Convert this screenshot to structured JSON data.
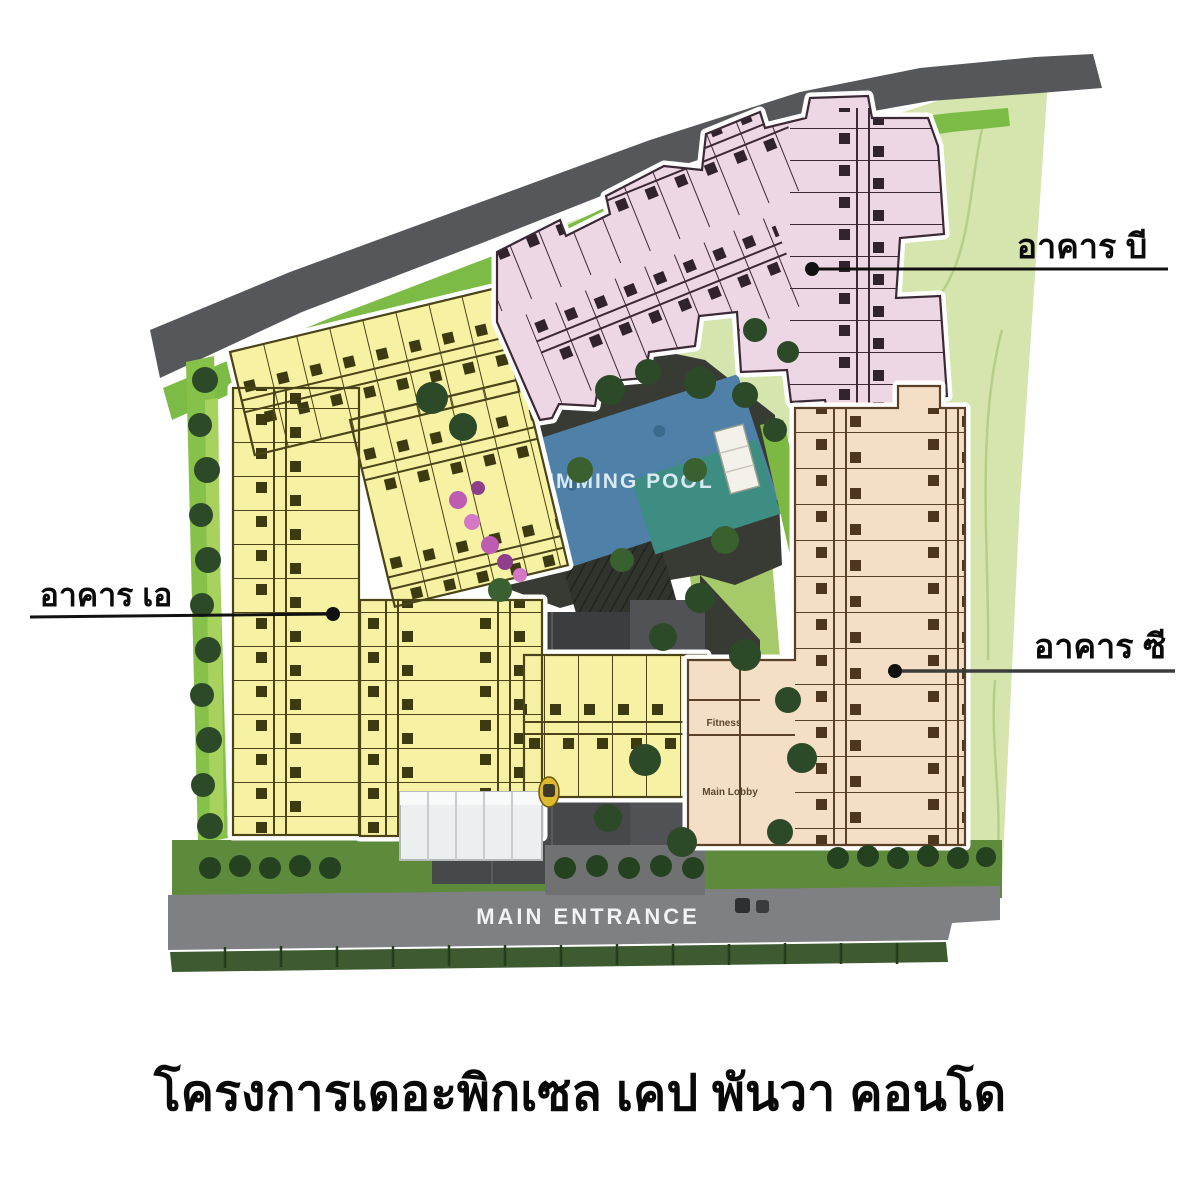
{
  "title": "โครงการเดอะพิกเซล เคป พันวา คอนโด",
  "site_plan": {
    "pool": {
      "label": "SWIMMING POOL",
      "color_main": "#4e80a8",
      "color_secondary": "#3e8d83"
    },
    "entrance": {
      "label": "MAIN ENTRANCE",
      "road_color": "#7e8083"
    },
    "buildings": {
      "a": {
        "label": "อาคาร เอ",
        "color": "#f7f2a3"
      },
      "b": {
        "label": "อาคาร บี",
        "color": "#eed7e4"
      },
      "c": {
        "label": "อาคาร ซี",
        "color": "#f4dfc6",
        "rooms": {
          "fitness": "Fitness",
          "lobby": "Main Lobby"
        }
      }
    },
    "colors": {
      "top_road": "#55575a",
      "verge_green": "#7cbb45",
      "east_lawn": "#d5e5ad",
      "bottom_lawn": "#5e8a3b",
      "hedge_strip": "#3d5a30",
      "tree_green": "#2c4a28",
      "deck_dark": "#383b34",
      "parking_gray": "#47484a"
    }
  }
}
